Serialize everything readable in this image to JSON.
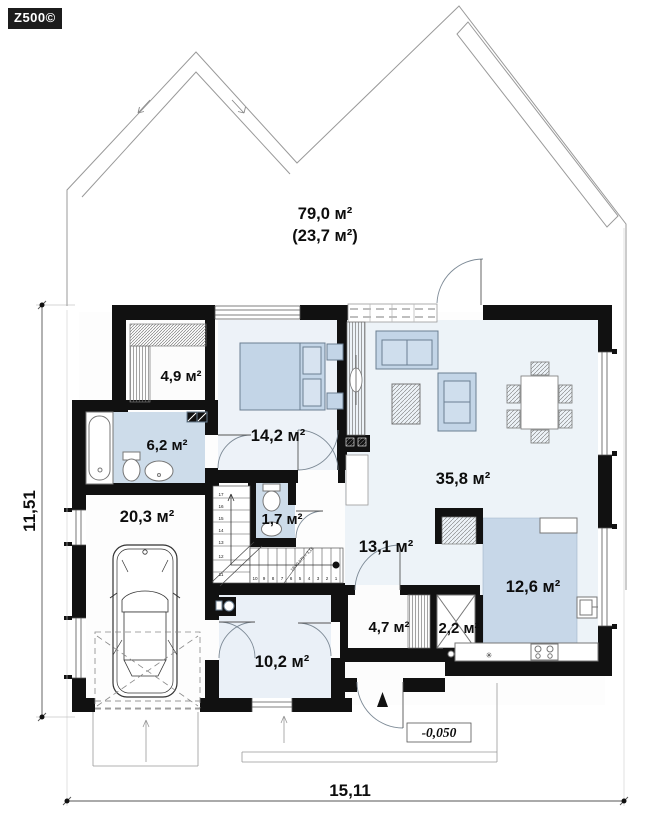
{
  "logo": "Z500©",
  "attic": {
    "line1": "79,0 м²",
    "line2": "(23,7 м²)"
  },
  "rooms": {
    "wardrobe": "4,9 м²",
    "bathroom": "6,2 м²",
    "bedroom": "14,2 м²",
    "living": "35,8 м²",
    "garage": "20,3 м²",
    "wc": "1,7 м²",
    "hall": "13,1 м²",
    "kitchen": "12,6 м²",
    "pantry": "4,7 м²",
    "tech": "2,2 м²",
    "hallway": "10,2 м²"
  },
  "dimensions": {
    "width": "15,11",
    "height": "11,51",
    "level": "-0,050"
  },
  "stairs": {
    "formula": "18 x0,175 = 3,15",
    "upper": [
      "17",
      "16",
      "15",
      "14",
      "13"
    ],
    "mid": [
      "12",
      "11"
    ],
    "lower": [
      "10",
      "9",
      "8",
      "7",
      "6",
      "5",
      "4",
      "3",
      "2",
      "1"
    ]
  },
  "symbols": {
    "kitchen_star": "✳"
  },
  "colors": {
    "wall": "#111111",
    "floor_blue": "#edf2f8",
    "zone_blue": "#cddcea",
    "kitchen_blue": "#c7d7e8",
    "furniture_blue": "#c3d5e7",
    "line_gray": "#888888"
  }
}
